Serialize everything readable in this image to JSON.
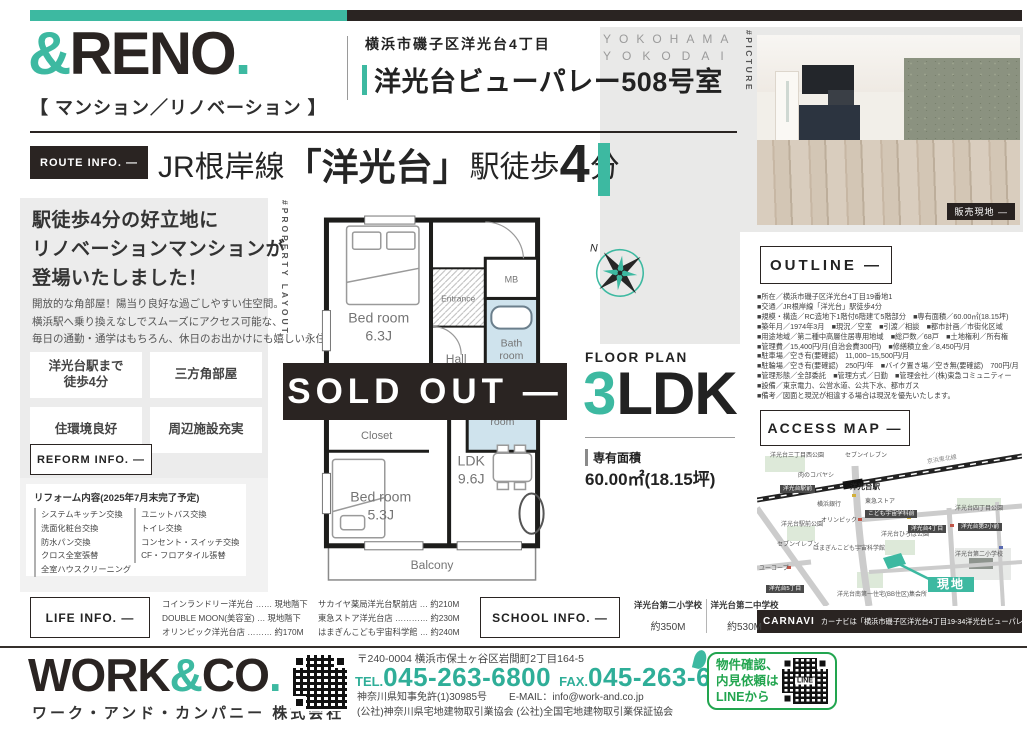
{
  "colors": {
    "accent": "#3db9a1",
    "dark": "#2a2422",
    "line_green": "#22a54f",
    "bath_blue": "#cfe3ed"
  },
  "brand": {
    "logo_amp": "&",
    "logo_name": "RENO",
    "logo_dot": ".",
    "logo_sub": "【 マンション／リノベーション 】"
  },
  "header": {
    "address": "横浜市磯子区洋光台4丁目",
    "title": "洋光台ビューパレー508号室",
    "kicker_line1": "YOKOHAMA",
    "kicker_line2": "YOKODAI",
    "picture_tag": "#PICTURE",
    "photo_caption": "販売現地 ―"
  },
  "route": {
    "label": "ROUTE INFO. —",
    "line": "JR根岸線",
    "open": "「",
    "station": "洋光台",
    "close": "」",
    "walk_prefix": "駅徒歩",
    "walk_minutes": "4",
    "walk_suffix": "分"
  },
  "lead": {
    "headline": [
      "駅徒歩4分の好立地に",
      "リノベーションマンションが",
      "登場いたしました！"
    ],
    "body": [
      "開放的な角部屋！陽当り良好な過ごしやすい住空間。",
      "横浜駅へ乗り換えなしでスムーズにアクセス可能な、",
      "毎日の通勤・通学はもちろん、休日のお出かけにも嬉しい永住地です。"
    ],
    "features": [
      "洋光台駅まで\n徒歩4分",
      "三方角部屋",
      "住環境良好",
      "周辺施設充実"
    ]
  },
  "reform": {
    "label": "REFORM INFO. —",
    "title": "リフォーム内容(2025年7月末完了予定)",
    "items_col1": [
      "システムキッチン交換",
      "洗面化粧台交換",
      "防水パン交換",
      "クロス全室張替",
      "全室ハウスクリーニング"
    ],
    "items_col2": [
      "ユニットバス交換",
      "トイレ交換",
      "コンセント・スイッチ交換",
      "CF・フロアタイル張替"
    ]
  },
  "floor_plan": {
    "tag": "#PROPERTY LAYOUT",
    "sold_out": "SOLD OUT ―",
    "label": "FLOOR PLAN",
    "type_number": "3",
    "type_suffix": "LDK",
    "area_label": "専有面積",
    "area_value": "60.00㎡(18.15坪)",
    "compass_n": "N",
    "rooms": {
      "bed1": "Bed room",
      "bed1_size": "6.3J",
      "entrance": "Entrance",
      "mb": "MB",
      "bath1": "Bath",
      "bath2": "room",
      "hall": "Hall",
      "powder1": "Powder",
      "powder2": "room",
      "closet1": "Closet",
      "clo": "Clo",
      "closet2": "Closet",
      "bed2": "Bed room",
      "bed2_size": "5.3J",
      "ldk": "LDK",
      "ldk_size": "9.6J",
      "balcony": "Balcony"
    }
  },
  "outline": {
    "label": "OUTLINE —",
    "rows": [
      "■所在／横浜市磯子区洋光台4丁目19番地1",
      "■交通／JR根岸線「洋光台」駅徒歩4分",
      "■規模・構造／RC造地下1階付6階建て5階部分　■専有面積／60.00㎡(18.15坪)",
      "■築年月／1974年3月　■現況／空室　■引渡／相談　■都市計画／市街化区域",
      "■用途地域／第二種中高層住居専用地域　■総戸数／68戸　■土地権利／所有権",
      "■管理費／15,400円/月(自治会費300円)　■修繕積立金／8,450円/月",
      "■駐車場／空き有(要確認)　11,000~15,500円/月",
      "■駐輪場／空き有(要確認)　250円/年　■バイク置き場／空き無(要確認)　700円/月",
      "■管理形態／全部委託　■管理方式／日勤　■管理会社／(株)東急コミュニティー",
      "■設備／東京電力、公営水道、公共下水、都市ガス",
      "■備考／図面と現況が相違する場合は現況を優先いたします。"
    ]
  },
  "access_map": {
    "label": "ACCESS MAP —",
    "carnavi_label": "CARNAVI",
    "carnavi_text": "カーナビは「横浜市磯子区洋光台4丁目19-34洋光台ビューパレー」とセット",
    "labels": [
      {
        "text": "洋光台三丁目西公園",
        "x": 13,
        "y": 3
      },
      {
        "text": "セブンイレブン",
        "x": 88,
        "y": 3
      },
      {
        "text": "京浜東北線",
        "x": 170,
        "y": 7,
        "cls": "rot"
      },
      {
        "text": "肉のコバヤシ",
        "x": 41,
        "y": 23
      },
      {
        "text": "洋光台駅前",
        "x": 23,
        "y": 35,
        "cls": "dark"
      },
      {
        "text": "洋光台駅",
        "x": 93,
        "y": 33,
        "cls": "big"
      },
      {
        "text": "横浜銀行",
        "x": 60,
        "y": 52
      },
      {
        "text": "東急ストア",
        "x": 108,
        "y": 49
      },
      {
        "text": "こども宇宙学科前",
        "x": 108,
        "y": 60,
        "cls": "dark"
      },
      {
        "text": "オリンピック",
        "x": 64,
        "y": 68
      },
      {
        "text": "洋光台四丁目公園",
        "x": 198,
        "y": 56
      },
      {
        "text": "洋光台第2小前",
        "x": 201,
        "y": 73,
        "cls": "dark"
      },
      {
        "text": "洋光台4丁目",
        "x": 151,
        "y": 75,
        "cls": "dark"
      },
      {
        "text": "洋光台ひろば公園",
        "x": 124,
        "y": 82
      },
      {
        "text": "洋光台駅前公園",
        "x": 24,
        "y": 72
      },
      {
        "text": "セブンイレブン",
        "x": 20,
        "y": 92
      },
      {
        "text": "はまぎんこども宇宙科学館",
        "x": 56,
        "y": 96
      },
      {
        "text": "洋光台第二小学校",
        "x": 198,
        "y": 102
      },
      {
        "text": "ユーコープ",
        "x": 2,
        "y": 116
      },
      {
        "text": "洋光台5丁目",
        "x": 9,
        "y": 135,
        "cls": "dark"
      },
      {
        "text": "洋光台南第一住宅(BB住区)集会所",
        "x": 80,
        "y": 142
      },
      {
        "text": "現地",
        "x": 171,
        "y": 127,
        "cls": "site"
      }
    ]
  },
  "life_info": {
    "label": "LIFE INFO. —",
    "col1": [
      "コインランドリー洋光台 …… 現地階下",
      "DOUBLE MOON(美容室) … 現地階下",
      "オリンピック洋光台店 ……… 約170M"
    ],
    "col2": [
      "サカイヤ薬局洋光台駅前店 … 約210M",
      "東急ストア洋光台店 ………… 約230M",
      "はまぎんこども宇宙科学館 … 約240M"
    ]
  },
  "school_info": {
    "label": "SCHOOL INFO. —",
    "entries": [
      {
        "name": "洋光台第二小学校",
        "dist": "約350M"
      },
      {
        "name": "洋光台第二中学校",
        "dist": "約530M"
      }
    ]
  },
  "footer": {
    "logo_p1": "WORK",
    "logo_amp": "&",
    "logo_p2": "CO",
    "logo_dot": ".",
    "company": "ワーク・アンド・カンパニー 株式会社",
    "postal": "〒240-0004 横浜市保土ヶ谷区岩間町2丁目164-5",
    "tel_label": "TEL.",
    "tel": "045-263-6800",
    "fax_label": "FAX.",
    "fax": "045-263-6839",
    "license": "神奈川県知事免許(1)30985号",
    "email": "E-MAIL：info@work-and.co.jp",
    "associations": "(公社)神奈川県宅地建物取引業協会 (公社)全国宅地建物取引業保証協会"
  },
  "line_box": {
    "lines": [
      "物件確認、",
      "内見依頼は",
      "LINEから"
    ],
    "qr_label": "LINE"
  }
}
